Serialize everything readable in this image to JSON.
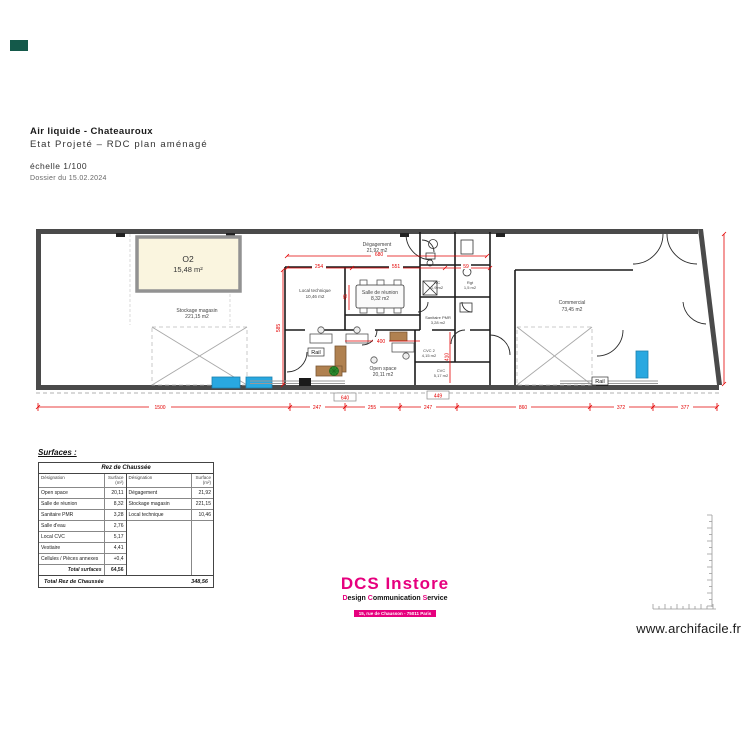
{
  "sheet": {
    "title": "Air liquide - Chateauroux",
    "subtitle": "Etat Projeté – RDC plan aménagé",
    "scale": "échelle 1/100",
    "dossier": "Dossier du 15.02.2024"
  },
  "plan": {
    "o2": {
      "name": "O2",
      "area": "15,48 m²"
    },
    "rooms": [
      {
        "name": "Stockage magasin",
        "area": "221,15 m2"
      },
      {
        "name": "Dégagement",
        "area": "21,92 m2"
      },
      {
        "name": "Local technique",
        "area": "10,46 m2"
      },
      {
        "name": "Salle de réunion",
        "area": "8,32 m2"
      },
      {
        "name": "WC",
        "area": "1,9 m2"
      },
      {
        "name": "Rgt",
        "area": "1,5 m2"
      },
      {
        "name": "Sanitaire PMR",
        "area": "3,28 m2"
      },
      {
        "name": "Open space",
        "area": "20,11 m2"
      },
      {
        "name": "CVC 2",
        "area": "4,15 m2"
      },
      {
        "name": "CVC",
        "area": "5,17 m2"
      },
      {
        "name": "Commercial",
        "area": "73,45 m2"
      }
    ],
    "rail_label": "Rail",
    "dims": {
      "top_total": "680",
      "top_row": [
        "254",
        "551",
        "59"
      ],
      "left_vertical": "585",
      "inner_vertical": "45",
      "open_space_width": "400",
      "inner_right_vertical": "410",
      "boxed": [
        "640",
        "449"
      ],
      "bottom": [
        "1500",
        "247",
        "255",
        "247",
        "860",
        "372",
        "377"
      ]
    }
  },
  "surfaces": {
    "title": "Surfaces :",
    "table_title": "Rez de Chaussée",
    "col_designation": "Désignation",
    "col_surface": "Surface (m²)",
    "left_rows": [
      {
        "name": "Open space",
        "value": "20,11"
      },
      {
        "name": "Salle de réunion",
        "value": "8,32"
      },
      {
        "name": "Sanitaire PMR",
        "value": "3,28"
      },
      {
        "name": "Salle d'eau",
        "value": "2,76"
      },
      {
        "name": "Local CVC",
        "value": "5,17"
      },
      {
        "name": "Vestiaire",
        "value": "4,41"
      },
      {
        "name": "Cellules / Pièces annexes",
        "value": "+0,4"
      }
    ],
    "total_label": "Total surfaces",
    "total_value": "64,56",
    "right_rows": [
      {
        "name": "Dégagement",
        "value": "21,92"
      },
      {
        "name": "Stockage magasin",
        "value": "221,15"
      },
      {
        "name": "Local technique",
        "value": "10,46"
      }
    ],
    "footer_label": "Total Rez de Chaussée",
    "footer_value": "348,56"
  },
  "footer": {
    "logo_title": "DCS Instore",
    "logo_words": [
      {
        "initial": "D",
        "rest": "esign "
      },
      {
        "initial": "C",
        "rest": "ommunication "
      },
      {
        "initial": "S",
        "rest": "ervice"
      }
    ],
    "logo_address": "15, rue de Chausson - 75011 Paris",
    "website": "www.archifacile.fr"
  },
  "colors": {
    "accent_pink": "#e6007e",
    "dim_red": "#e30000",
    "highlight_fill": "#faf5df",
    "blue_item": "#29a8e0",
    "teal_mark": "#14594a"
  }
}
